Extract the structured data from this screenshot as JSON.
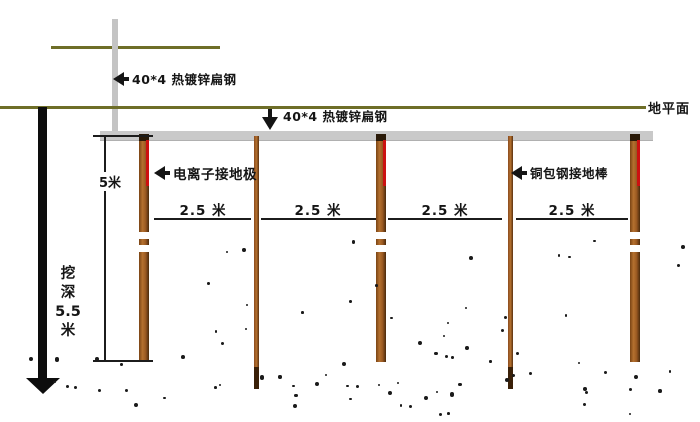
{
  "labels": {
    "flat_steel_riser": "40*4 热镀锌扁钢",
    "flat_steel_buried": "40*4 热镀锌扁钢",
    "ground_level": "地平面",
    "ion_electrode": "电离子接地极",
    "copper_clad_rod": "铜包钢接地棒"
  },
  "dimensions": {
    "electrode_length": "5米",
    "spacing_labels": [
      "2.5 米",
      "2.5 米",
      "2.5 米",
      "2.5 米"
    ],
    "dig_depth_lines": [
      "挖",
      "深",
      "5.5",
      "米"
    ]
  },
  "colors": {
    "ground_line": "#6e6e28",
    "flat_steel_gray": "#c9c9c9",
    "rod_brown": "#b5712f",
    "rod_dark": "#4a2a0c",
    "electrode_red": "#cc1111",
    "ink": "#151515"
  }
}
